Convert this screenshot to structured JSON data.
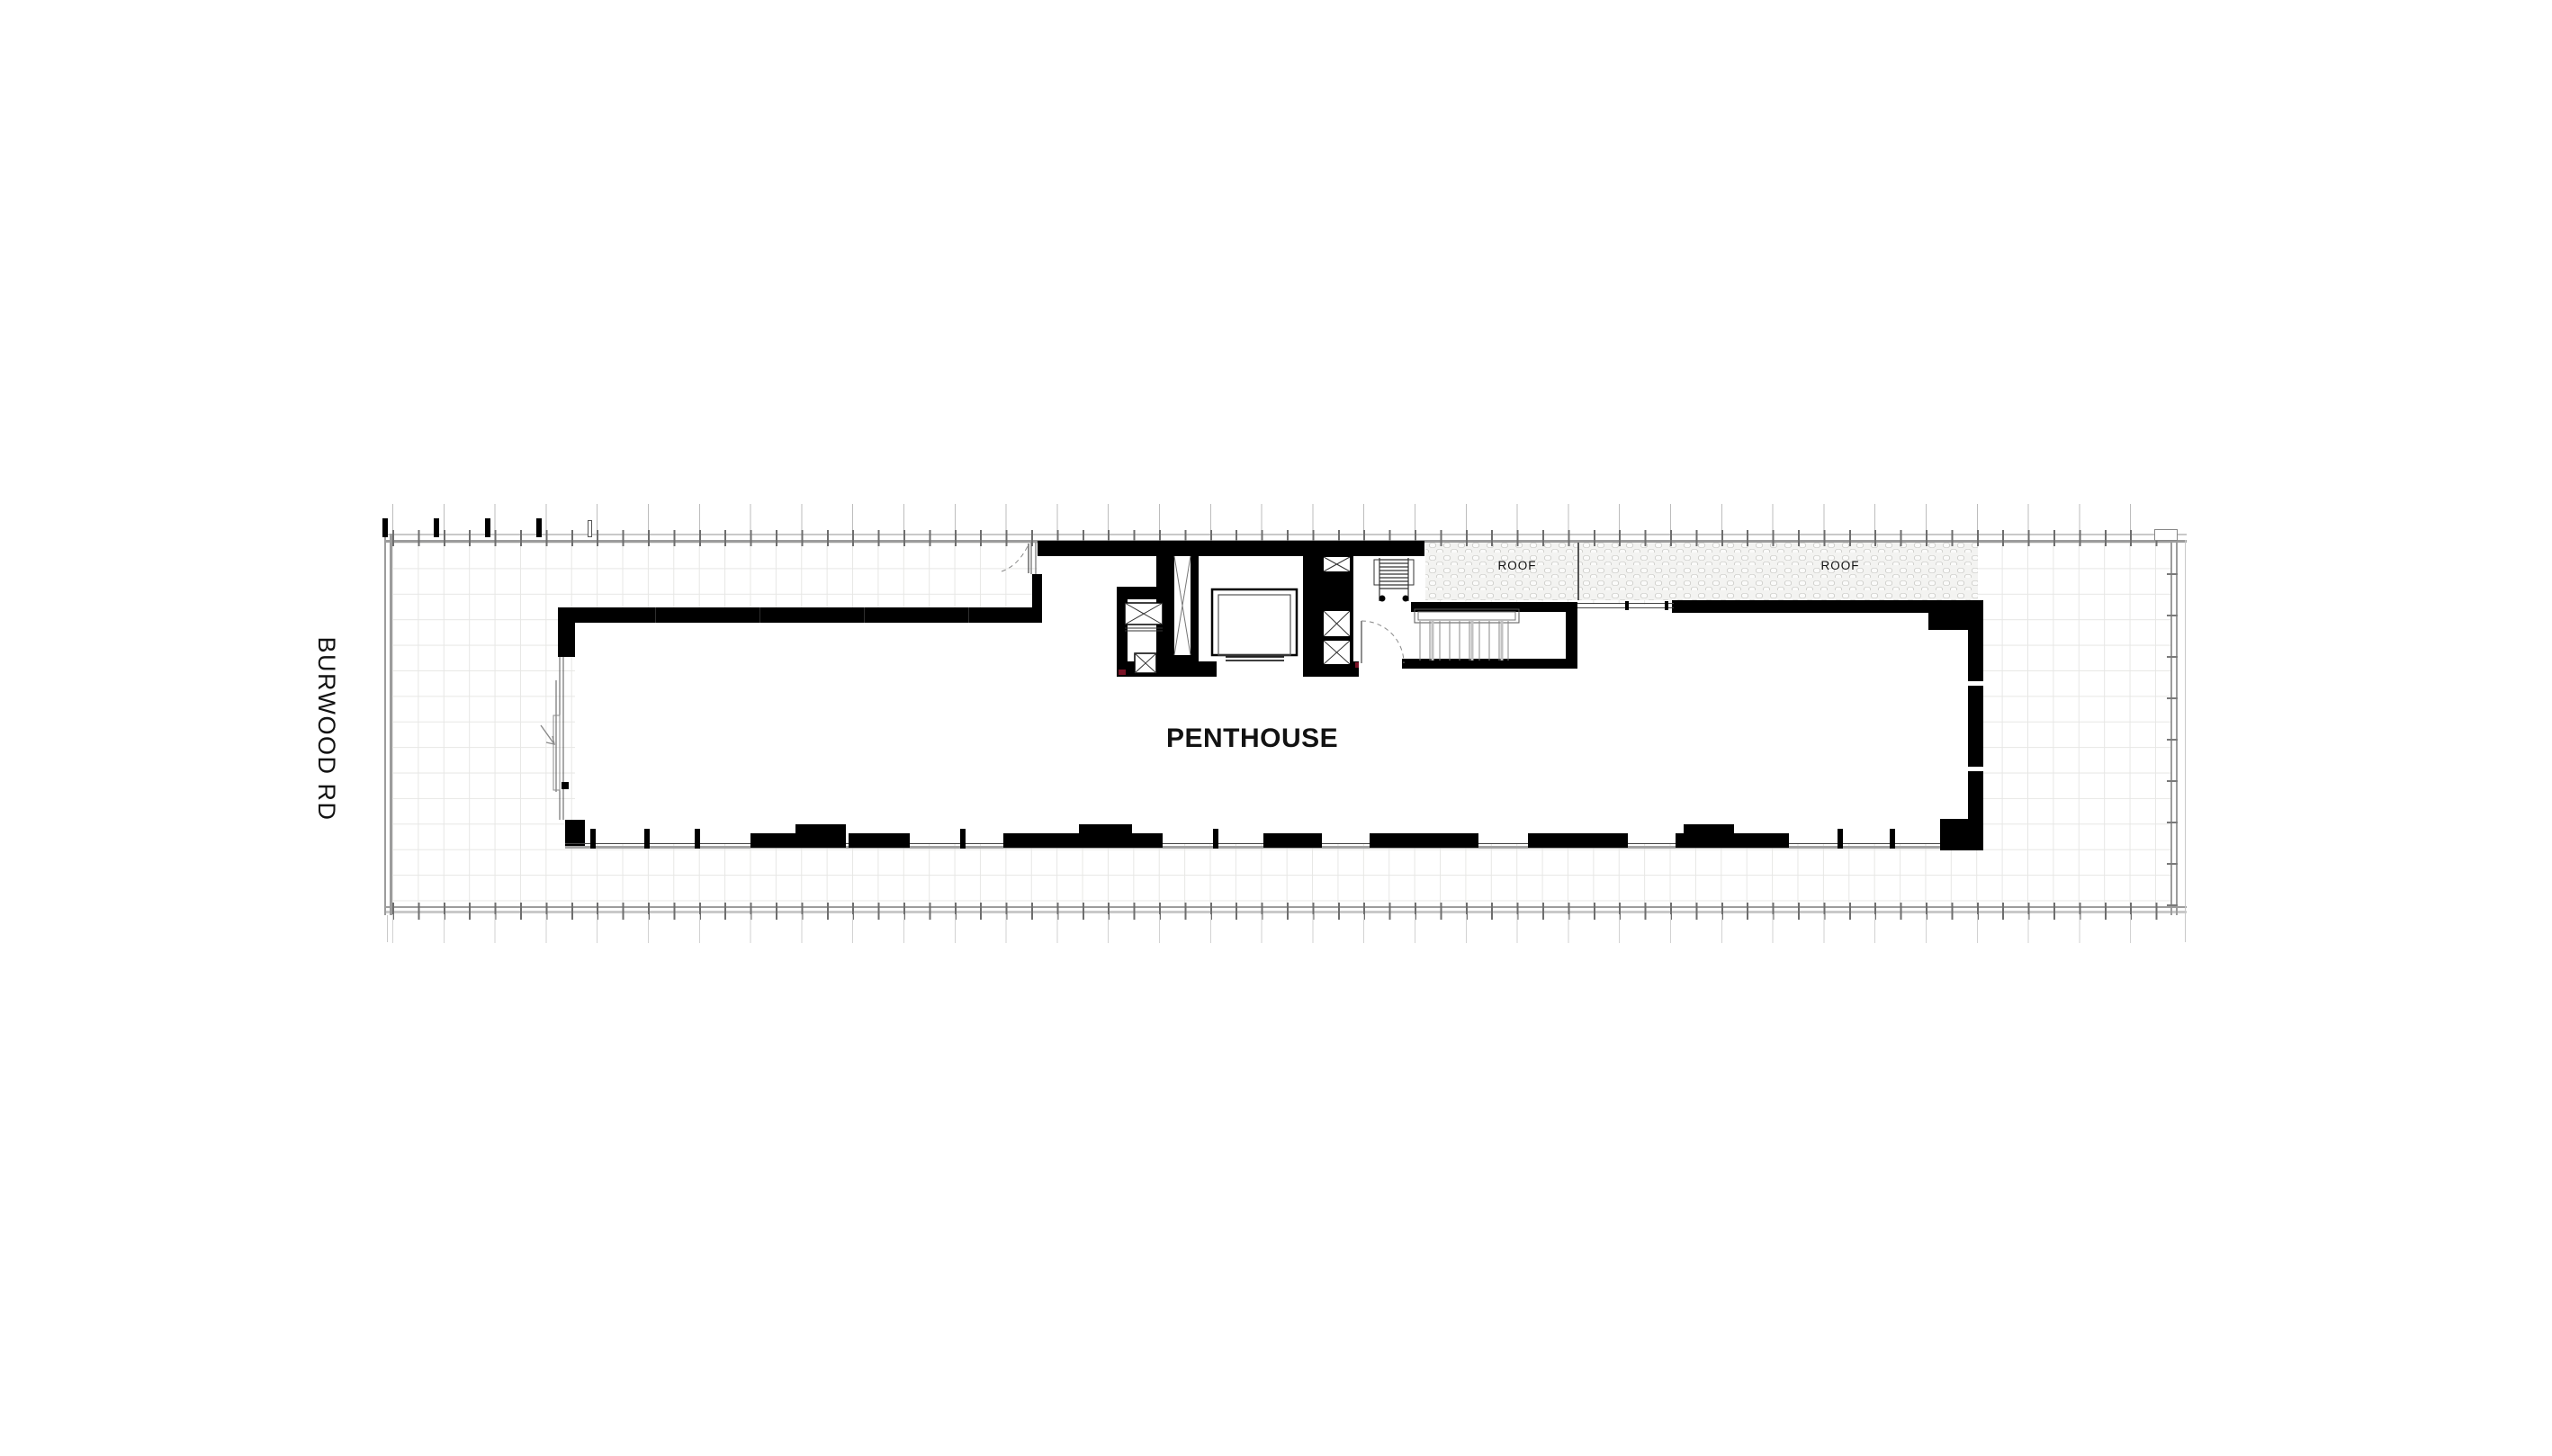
{
  "labels": {
    "street": "BURWOOD RD",
    "unit": "PENTHOUSE",
    "roof_left": "ROOF",
    "roof_right": "ROOF"
  },
  "colors": {
    "wall": "#000000",
    "boundary_line": "#9c9c9c",
    "grid_line": "#e7e7e5",
    "pebble_background": "#f3f3f1",
    "pebble_outline": "#b9b9b4",
    "marker_red": "#7a1326",
    "text": "#121212"
  }
}
